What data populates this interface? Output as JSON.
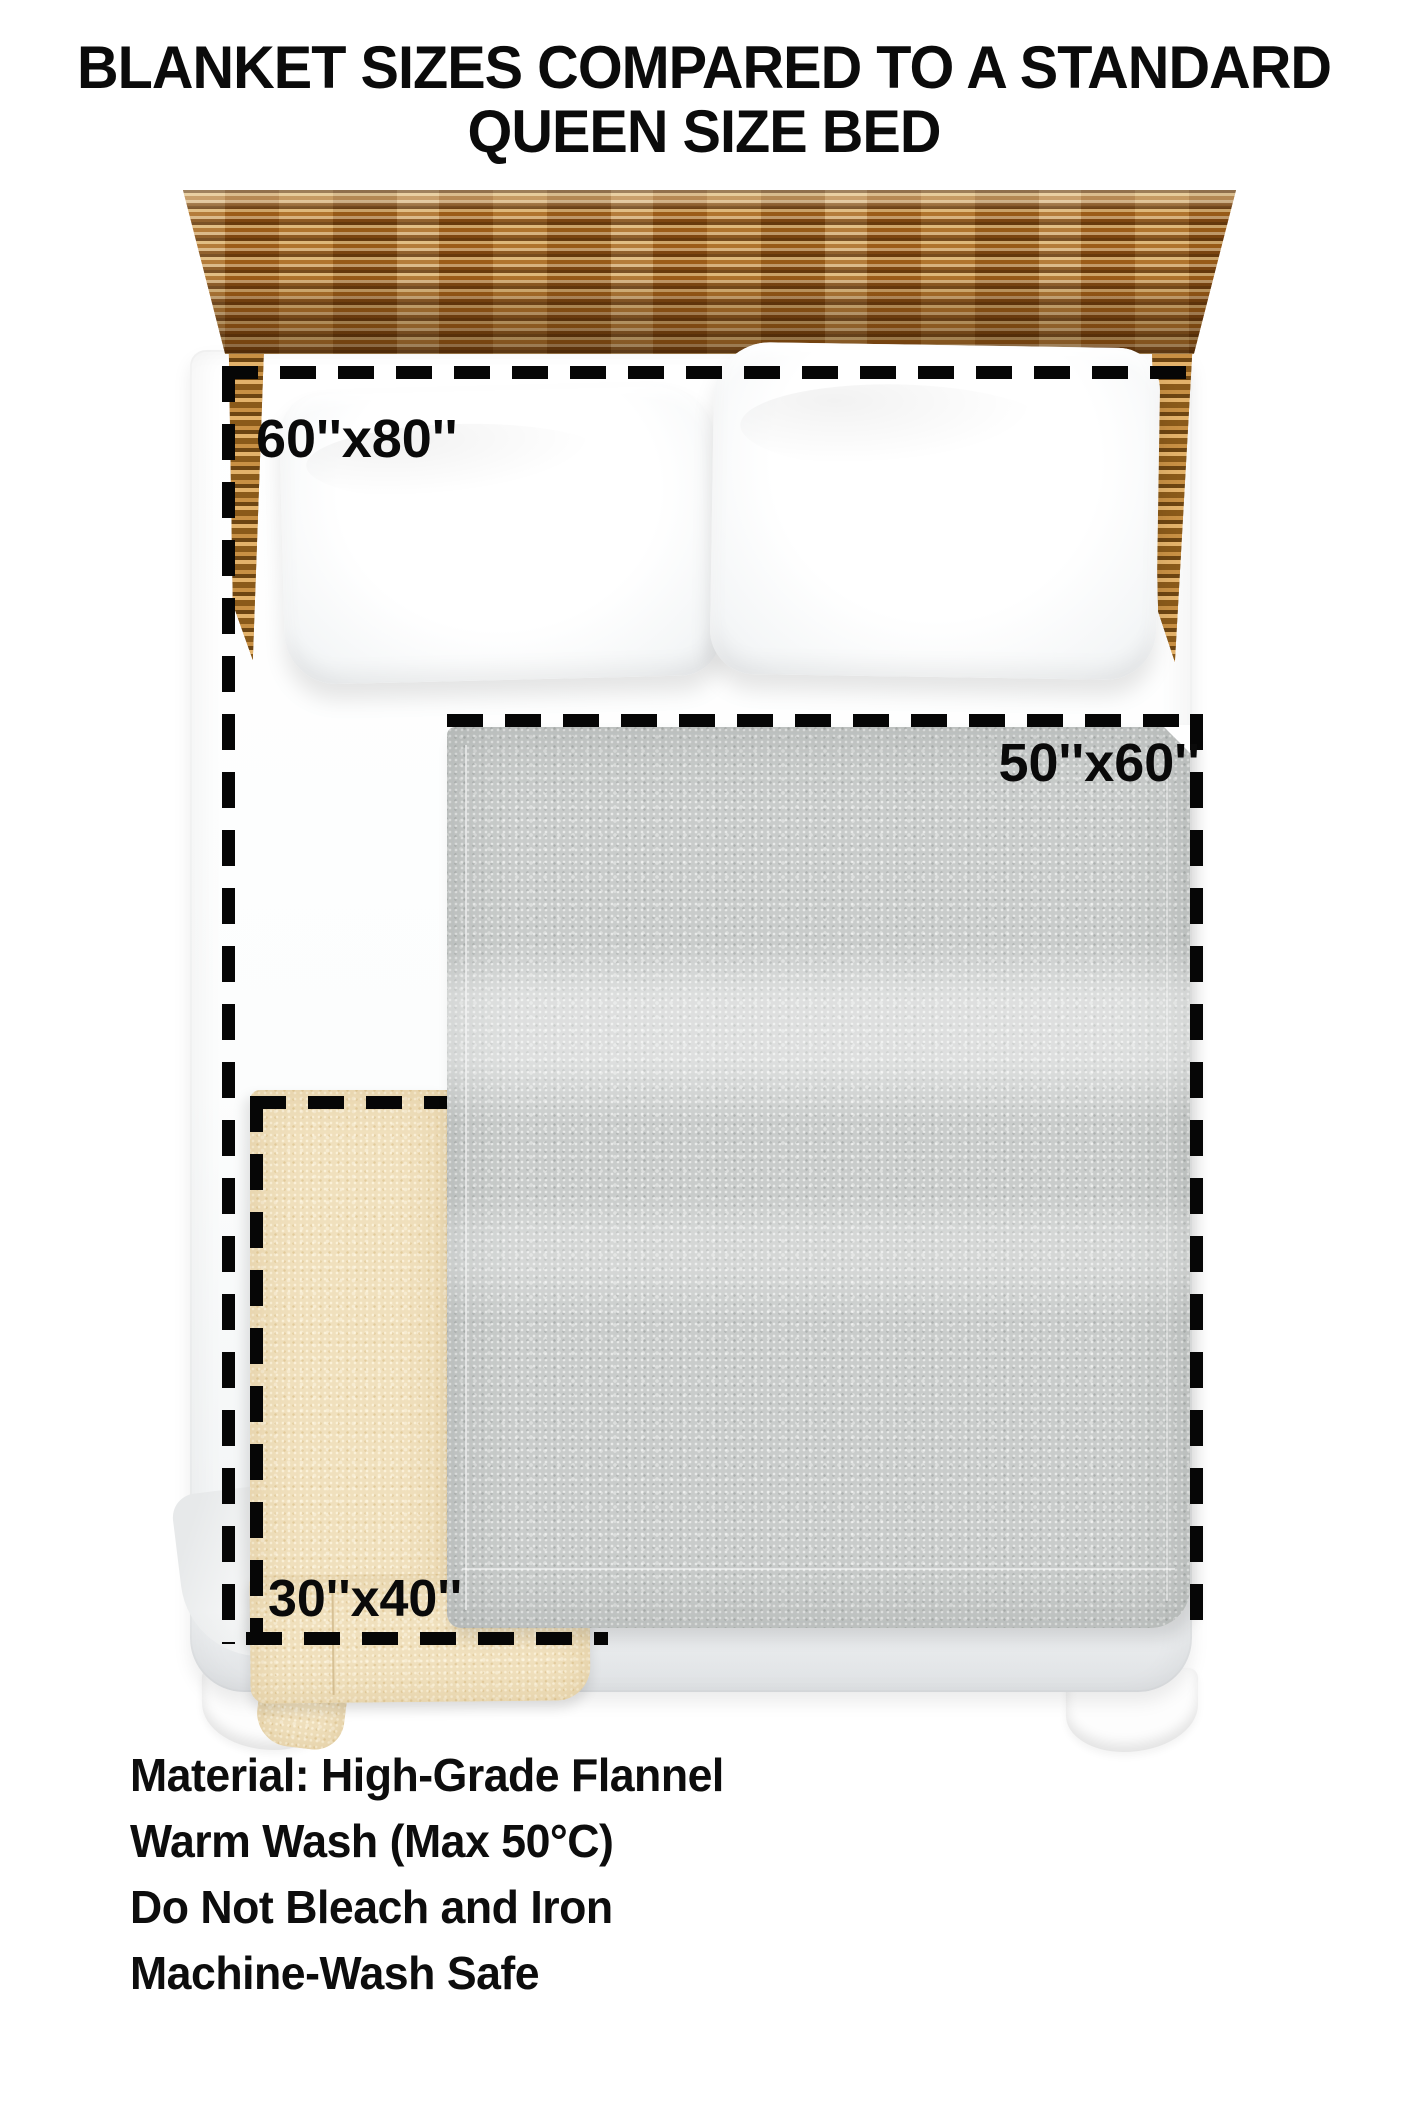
{
  "title": {
    "line1": "BLANKET SIZES COMPARED TO A STANDARD",
    "line2": "QUEEN SIZE BED"
  },
  "size_labels": {
    "queen_bed": "60''x80''",
    "medium_blanket": "50''x60''",
    "small_blanket": "30''x40''"
  },
  "care_instructions": [
    "Material: High-Grade Flannel",
    "Warm Wash (Max 50°C)",
    "Do Not Bleach and Iron",
    "Machine-Wash Safe"
  ],
  "colors": {
    "background": "#ffffff",
    "dash_line": "#060606",
    "blanket_gray": "#c9cccb",
    "blanket_cream": "#f0e0bd",
    "headboard_wood": "#a9671c",
    "text": "#0d0d0d"
  }
}
